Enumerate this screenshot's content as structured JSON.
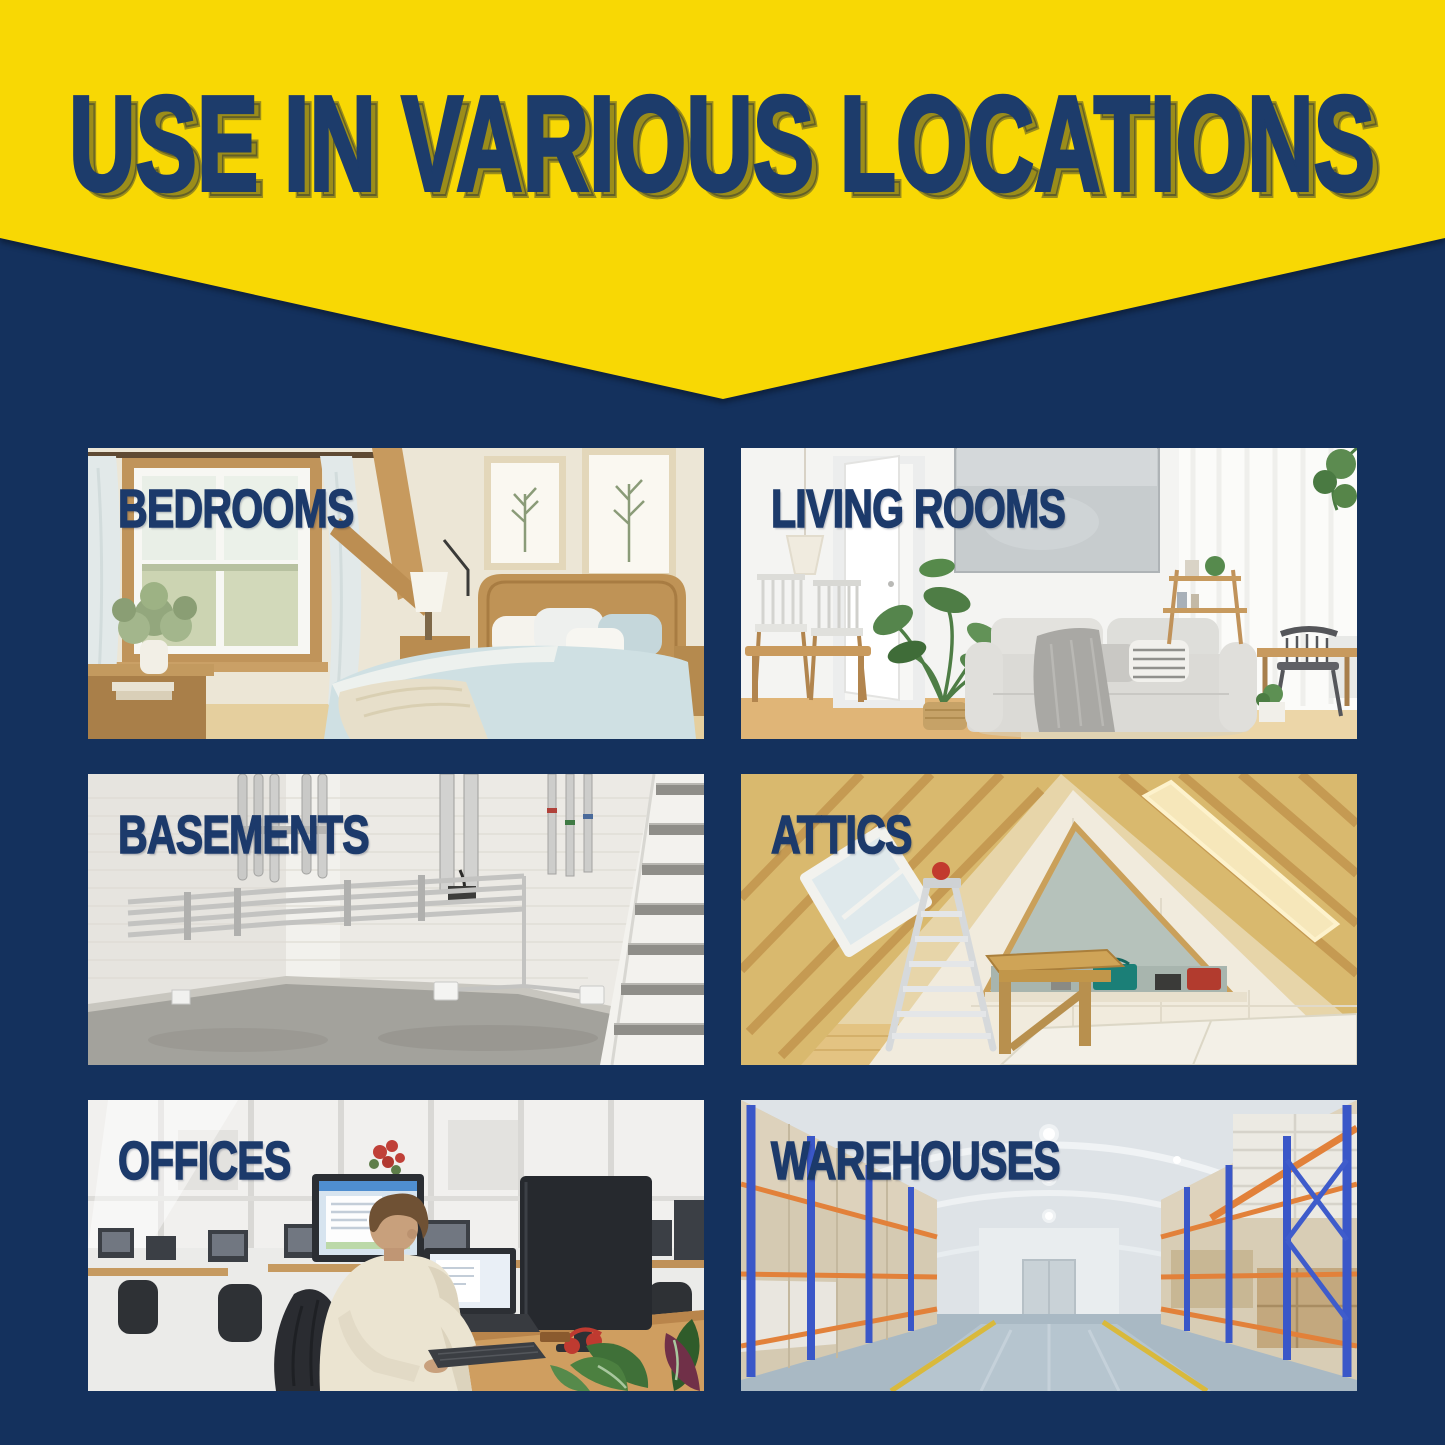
{
  "banner": {
    "title": "USE IN VARIOUS LOCATIONS"
  },
  "tiles": [
    {
      "id": "bedrooms",
      "label": "BEDROOMS"
    },
    {
      "id": "living-rooms",
      "label": "LIVING ROOMS"
    },
    {
      "id": "basements",
      "label": "BASEMENTS"
    },
    {
      "id": "attics",
      "label": "ATTICS"
    },
    {
      "id": "offices",
      "label": "OFFICES"
    },
    {
      "id": "warehouses",
      "label": "WAREHOUSES"
    }
  ],
  "colors": {
    "background_navy": "#14315D",
    "banner_yellow": "#F8D804",
    "text_navy": "#1C3A6B"
  }
}
